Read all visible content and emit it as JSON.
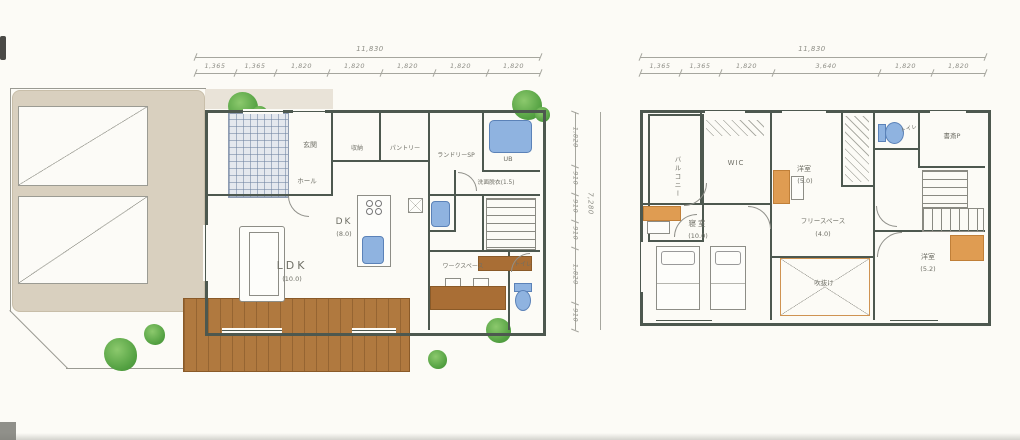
{
  "palette": {
    "paper": "#fcfbf6",
    "wall": "#4d584f",
    "pencil_gray": "#8f8f87",
    "site_beige": "#d9d0bf",
    "wood_brown": "#b0793f",
    "closet_orange": "#df9c52",
    "fixture_blue": "#8fb3e0",
    "tree_green": "#55a243",
    "tile_blue_gray": "#8e9cb2"
  },
  "floor1": {
    "dims": {
      "total_top": "11,830",
      "top": [
        "1,365",
        "1,365",
        "1,820",
        "1,820",
        "1,820",
        "1,820",
        "1,820"
      ],
      "total_right": "7,280",
      "right": [
        "1,820",
        "910",
        "910",
        "910",
        "1,820",
        "910"
      ]
    },
    "rooms": {
      "genkan": {
        "label": "玄関"
      },
      "hall": {
        "label": "ホール"
      },
      "storage": {
        "label": "収納"
      },
      "pantry": {
        "label": "パントリー"
      },
      "laundry": {
        "label": "ランドリーSP"
      },
      "bath": {
        "label": "UB"
      },
      "sanitary": {
        "label": "洗面脱衣",
        "size": "(1.5)"
      },
      "dk": {
        "label": "DK",
        "size": "(8.0)"
      },
      "ldk": {
        "label": "LDK",
        "size": "(10.0)"
      },
      "workspace": {
        "label": "ワークスペース"
      },
      "toilet": {
        "label": "トイレ"
      }
    }
  },
  "floor2": {
    "dims": {
      "total_top": "11,830",
      "top": [
        "1,365",
        "1,365",
        "1,820",
        "3,640",
        "1,820",
        "1,820"
      ]
    },
    "rooms": {
      "balcony": {
        "label": "バルコニー"
      },
      "wic": {
        "label": "WIC"
      },
      "bedroom2": {
        "label": "洋室",
        "size": "(5.0)"
      },
      "toilet": {
        "label": "トイレ"
      },
      "study": {
        "label": "書斎P"
      },
      "master": {
        "label": "寝室",
        "size": "(10.0)"
      },
      "free_space": {
        "label": "フリースペース",
        "size": "(4.0)"
      },
      "void": {
        "label": "吹抜け"
      },
      "bedroom3": {
        "label": "洋室",
        "size": "(5.2)"
      }
    }
  }
}
